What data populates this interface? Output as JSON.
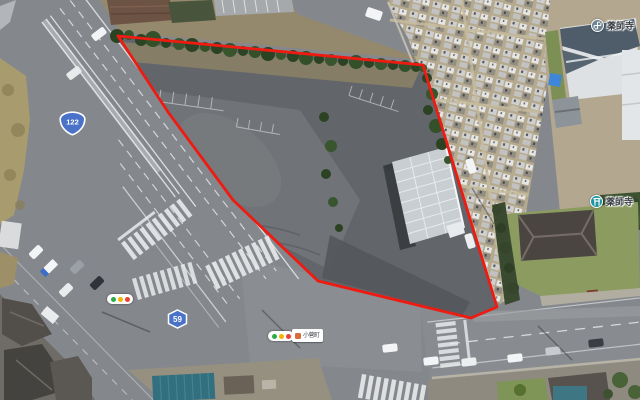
{
  "map": {
    "view": "satellite",
    "parcel": {
      "boundary_color": "#ee1b12",
      "note": "red outlined land parcel at road intersection"
    },
    "route_badges": [
      {
        "number": "122",
        "shape": "national-route-onigiri",
        "fill": "#4a72c8"
      },
      {
        "number": "59",
        "shape": "prefectural-route-hexagon",
        "fill": "#4a72c8"
      }
    ],
    "place_labels": [
      {
        "name": "薬師寺",
        "icon": "temple-manji-icon",
        "icon_color": "#6f8494"
      },
      {
        "name": "薬師寺",
        "icon": "shrine-torii-icon",
        "icon_color": "#1d96a2"
      }
    ],
    "street_label": {
      "name": "小菅町",
      "icon": "poi-dot-icon",
      "icon_color": "#d96c3a"
    },
    "traffic_signals": {
      "count": 2,
      "colors": [
        "#2faa4a",
        "#f4b400",
        "#e94335"
      ]
    }
  }
}
